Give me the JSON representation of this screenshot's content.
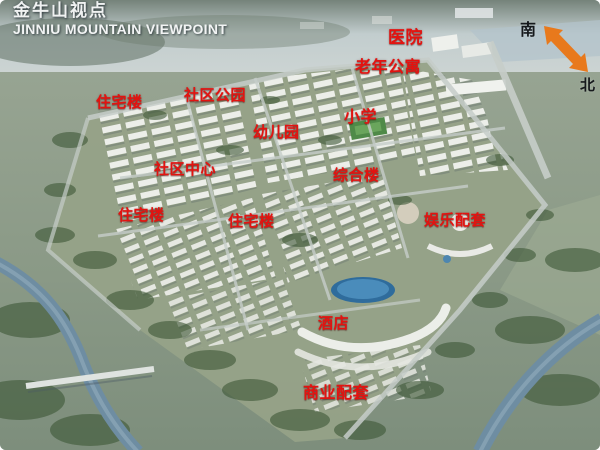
{
  "title": {
    "zh": "金牛山视点",
    "en": "JINNIU MOUNTAIN VIEWPOINT"
  },
  "compass": {
    "south": "南",
    "north": "北"
  },
  "labels": [
    {
      "id": "hospital",
      "text": "医院",
      "x": 388,
      "y": 29,
      "size": 17
    },
    {
      "id": "senior-apartments",
      "text": "老年公寓",
      "x": 355,
      "y": 58,
      "size": 16
    },
    {
      "id": "community-park",
      "text": "社区公园",
      "x": 184,
      "y": 87,
      "size": 15
    },
    {
      "id": "residential-1",
      "text": "住宅楼",
      "x": 96,
      "y": 94,
      "size": 15
    },
    {
      "id": "elementary-school",
      "text": "小学",
      "x": 344,
      "y": 108,
      "size": 16
    },
    {
      "id": "kindergarten",
      "text": "幼儿园",
      "x": 253,
      "y": 124,
      "size": 15
    },
    {
      "id": "community-center",
      "text": "社区中心",
      "x": 154,
      "y": 161,
      "size": 15
    },
    {
      "id": "complex-building",
      "text": "综合楼",
      "x": 333,
      "y": 167,
      "size": 15
    },
    {
      "id": "residential-2",
      "text": "住宅楼",
      "x": 118,
      "y": 207,
      "size": 15
    },
    {
      "id": "residential-3",
      "text": "住宅楼",
      "x": 228,
      "y": 213,
      "size": 15
    },
    {
      "id": "entertainment",
      "text": "娱乐配套",
      "x": 424,
      "y": 212,
      "size": 15
    },
    {
      "id": "hotel",
      "text": "酒店",
      "x": 318,
      "y": 315,
      "size": 15
    },
    {
      "id": "commercial",
      "text": "商业配套",
      "x": 303,
      "y": 384,
      "size": 16
    }
  ],
  "colors": {
    "label-red": "#e31310",
    "arrow-orange": "#e8791c",
    "title-white": "#f0f2f2",
    "compass-text": "#16191c"
  }
}
